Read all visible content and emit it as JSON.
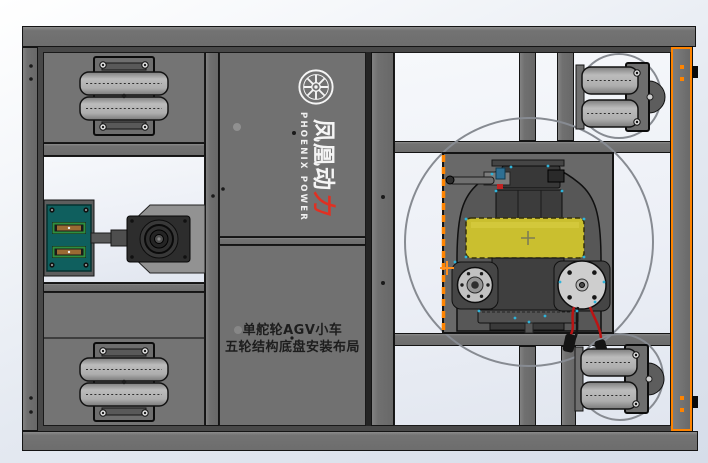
{
  "branding": {
    "logo_icon": "spoked-wheel-icon",
    "cn_main": "凤凰动",
    "cn_accent": "力",
    "en": "PHOENIX POWER",
    "text_color": "#f5f5f5",
    "accent_color": "#e03022"
  },
  "caption": {
    "line1": "单舵轮AGV小车",
    "line2": "五轮结构底盘安装布局",
    "color": "#1d1d1d"
  },
  "selection": {
    "edge_color": "#ff8400",
    "edge_style": "dashed",
    "origin_mark": "+"
  },
  "palette": {
    "frame_gray": "#6f6f6f",
    "panel_gray": "#747474",
    "opening_light": "#eef1f7",
    "mount_plate_gray": "#696969",
    "drive_wheel_yellow": "#cabf2f",
    "charger_teal": "#0f5f5e",
    "wire_red": "#bb1414",
    "edge_highlight_cyan": "#2fb3d9",
    "clearance_circle_gray": "#878b92"
  },
  "components": [
    "fixed-dual-roller-caster-front-left",
    "fixed-dual-roller-caster-rear-left",
    "charging-contact-block",
    "side-drive-motor",
    "steering-drive-unit",
    "drive-wheel",
    "steering-motor-disc",
    "encoder-disc",
    "swivel-caster-front-right",
    "swivel-caster-rear-right",
    "steering-clearance-circle"
  ]
}
